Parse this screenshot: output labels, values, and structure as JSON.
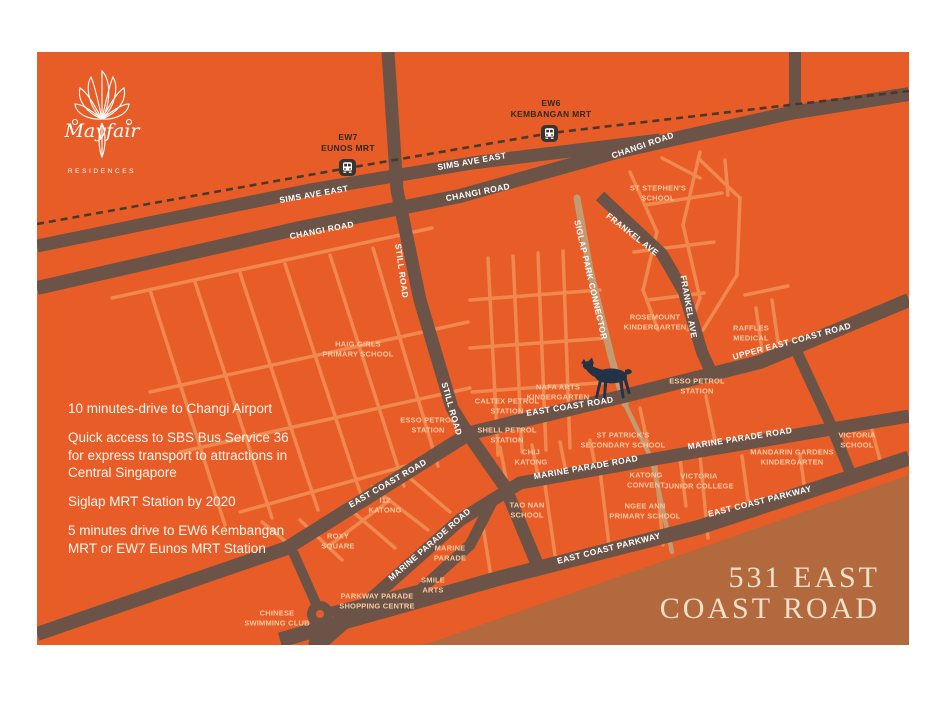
{
  "palette": {
    "background": "#E85C27",
    "major_road": "#6B5347",
    "minor_road": "#F0894F",
    "railway": "#4A392B",
    "park_connector": "#C49A72",
    "coast_block": "#B2693E",
    "place_label": "#F8C9A2",
    "road_label": "#FFFFFF",
    "mrt_label": "#312A21",
    "deer_marker": "#233247",
    "title_text": "#F3E0CB"
  },
  "brand": {
    "name": "Mayfair",
    "subtitle": "RESIDENCES"
  },
  "title_block": {
    "line1": "531 EAST",
    "line2": "COAST ROAD"
  },
  "info": {
    "p1": "10 minutes-drive to Changi Airport",
    "p2": "Quick access to SBS Bus Service 36\nfor express transport to attractions in\nCentral Singapore",
    "p3": "Siglap MRT Station by 2020",
    "p4": "5 minutes drive to EW6 Kembangan\nMRT or EW7 Eunos MRT Station"
  },
  "stations": {
    "ew7": {
      "label": "EW7\nEUNOS MRT"
    },
    "ew6": {
      "label": "EW6\nKEMBANGAN MRT"
    }
  },
  "roads": [
    "SIMS AVE EAST",
    "SIMS AVE EAST",
    "CHANGI ROAD",
    "CHANGI ROAD",
    "CHANGI ROAD",
    "STILL ROAD",
    "STILL ROAD",
    "SIGLAP PARK CONNECTOR",
    "FRANKEL AVE",
    "FRANKEL AVE",
    "UPPER EAST COAST ROAD",
    "EAST COAST ROAD",
    "EAST COAST ROAD",
    "MARINE PARADE ROAD",
    "MARINE PARADE ROAD",
    "MARINE PARADE ROAD",
    "EAST COAST PARKWAY",
    "EAST COAST PARKWAY"
  ],
  "places": [
    "ST STEPHEN'S\nSCHOOL",
    "HAIG GIRLS\nPRIMARY SCHOOL",
    "ROSEMOUNT\nKINDERGARTEN",
    "RAFFLES\nMEDICAL",
    "ESSO PETROL\nSTATION",
    "NAFA ARTS\nKINDERGARTEN",
    "CALTEX PETROL\nSTATION",
    "ESSO PETROL\nSTATION",
    "SHELL PETROL\nSTATION",
    "CHIJ\nKATONG",
    "ST PATRICK'S\nSECONDARY SCHOOL",
    "MANDARIN GARDENS\nKINDERGARTEN",
    "VICTORIA\nSCHOOL",
    "KATONG\nCONVENT",
    "VICTORIA\nJUNIOR COLLEGE",
    "TAO NAN\nSCHOOL",
    "NGEE ANN\nPRIMARY SCHOOL",
    "I12\nKATONG",
    "ROXY\nSQUARE",
    "MARINE\nPARADE",
    "SMILE\nARTS",
    "PARKWAY PARADE\nSHOPPING CENTRE",
    "CHINESE\nSWIMMING CLUB"
  ]
}
